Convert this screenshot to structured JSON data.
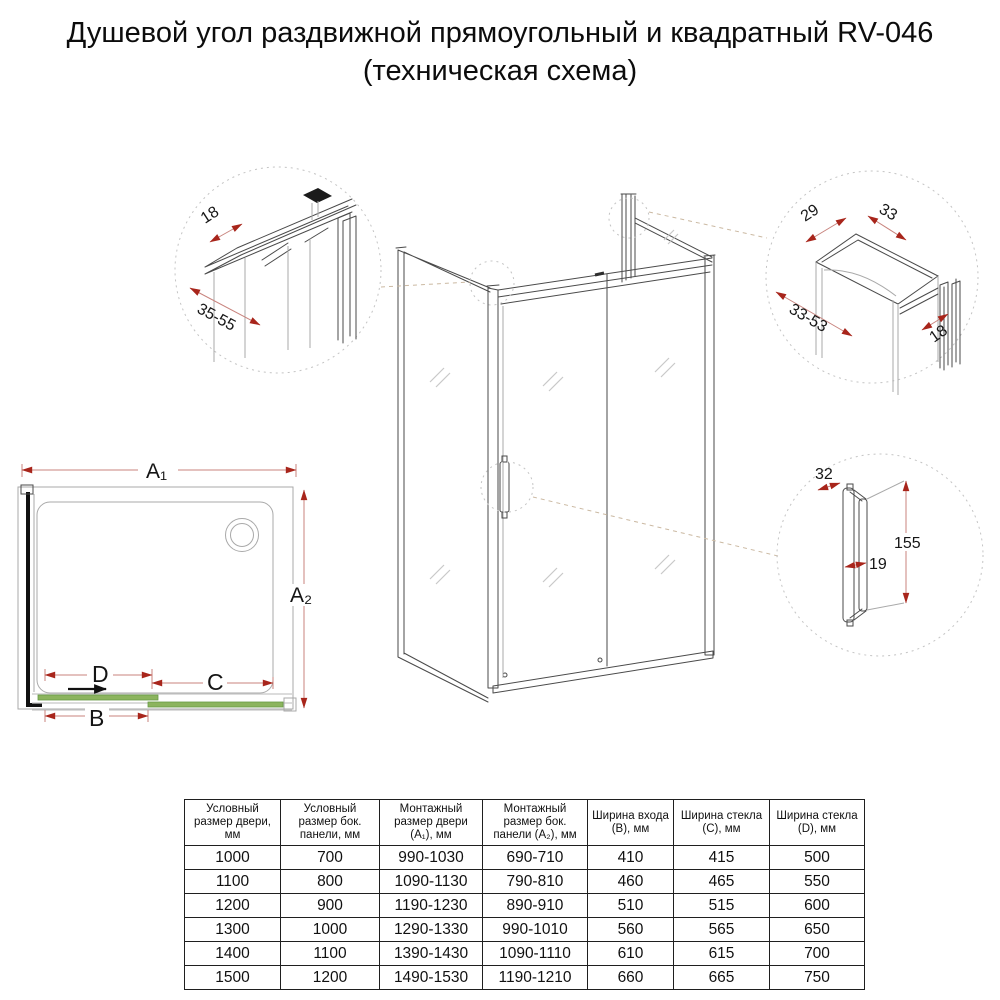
{
  "title": {
    "line1": "Душевой угол раздвижной прямоугольный и квадратный RV-046",
    "line2": "(техническая схема)"
  },
  "colors": {
    "accent_red": "#a8251b",
    "dim_line_red": "#c8837d",
    "glass_green": "#8cb45e",
    "glass_green_dark": "#679a44",
    "outline_gray": "#4a4a4a",
    "light_gray": "#a9a9a9"
  },
  "diagrams": {
    "wall_profile": {
      "thickness_mm": "18",
      "adjustment_range_mm": "35-55"
    },
    "door_profile": {
      "profile_width_mm": "29",
      "rail_width_mm": "33",
      "adjustment_range_mm": "33-53",
      "thickness_mm": "18"
    },
    "handle": {
      "depth_mm": "32",
      "grip_clearance_mm": "19",
      "height_mm": "155"
    },
    "plan": {
      "door_width_label": "A₁",
      "panel_width_label": "A₂",
      "entry_width_label": "B",
      "fixed_glass_label": "C",
      "door_glass_label": "D"
    }
  },
  "table": {
    "headers": [
      "Условный размер двери, мм",
      "Условный размер бок. панели, мм",
      "Монтажный размер двери (A₁), мм",
      "Монтажный размер бок. панели (A₂), мм",
      "Ширина входа (B), мм",
      "Ширина стекла (C), мм",
      "Ширина стекла (D), мм"
    ],
    "rows": [
      [
        "1000",
        "700",
        "990-1030",
        "690-710",
        "410",
        "415",
        "500"
      ],
      [
        "1100",
        "800",
        "1090-1130",
        "790-810",
        "460",
        "465",
        "550"
      ],
      [
        "1200",
        "900",
        "1190-1230",
        "890-910",
        "510",
        "515",
        "600"
      ],
      [
        "1300",
        "1000",
        "1290-1330",
        "990-1010",
        "560",
        "565",
        "650"
      ],
      [
        "1400",
        "1100",
        "1390-1430",
        "1090-1110",
        "610",
        "615",
        "700"
      ],
      [
        "1500",
        "1200",
        "1490-1530",
        "1190-1210",
        "660",
        "665",
        "750"
      ]
    ]
  }
}
